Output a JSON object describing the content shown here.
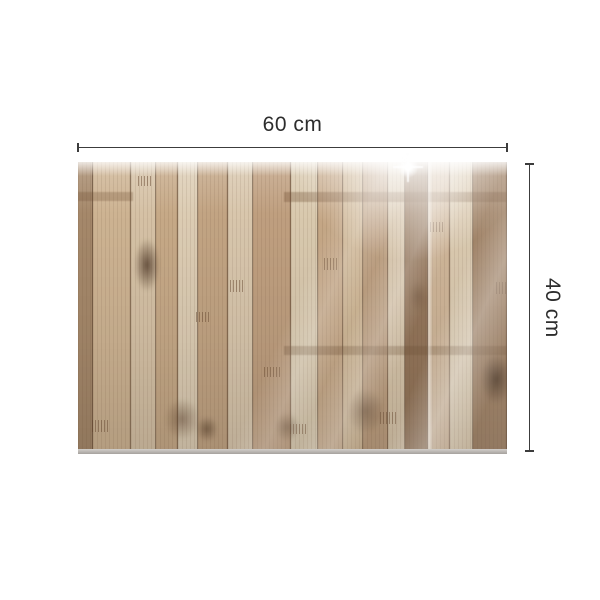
{
  "dimensions": {
    "width_label": "60 cm",
    "height_label": "40 cm",
    "line_color": "#3c3c3c",
    "label_color": "#2d2d2d"
  },
  "panel": {
    "description": "rustic wood plank print glass panel",
    "edge_color_top": "#d2cfcb",
    "edge_color_bottom": "#a6a29e",
    "seam_color": "rgba(74,52,34,0.45)",
    "planks": [
      {
        "w": 15,
        "color": "#a5886a"
      },
      {
        "w": 38,
        "color": "#cdb392"
      },
      {
        "w": 25,
        "color": "#d5c1a5"
      },
      {
        "w": 22,
        "color": "#c6a987"
      },
      {
        "w": 20,
        "color": "#dcccb3"
      },
      {
        "w": 30,
        "color": "#c2a483"
      },
      {
        "w": 25,
        "color": "#d8c6ac"
      },
      {
        "w": 38,
        "color": "#bf9f7f"
      },
      {
        "w": 27,
        "color": "#d9c9ae"
      },
      {
        "w": 25,
        "color": "#c5a786"
      },
      {
        "w": 20,
        "color": "#cdb492"
      },
      {
        "w": 25,
        "color": "#ba9b7b"
      },
      {
        "w": 17,
        "color": "#d4c1a5"
      },
      {
        "w": 23,
        "color": "#8e6e51"
      },
      {
        "w": 22,
        "color": "#cbb091"
      },
      {
        "w": 23,
        "color": "#d7c5a9"
      },
      {
        "w": 34,
        "color": "#9a7a5c"
      }
    ],
    "knots": [
      {
        "x": 56,
        "y": 76,
        "w": 26,
        "h": 54,
        "color": "rgba(66,44,28,0.75)"
      },
      {
        "x": 86,
        "y": 236,
        "w": 36,
        "h": 42,
        "color": "rgba(84,58,38,0.50)"
      },
      {
        "x": 268,
        "y": 226,
        "w": 38,
        "h": 46,
        "color": "rgba(80,54,34,0.50)"
      },
      {
        "x": 402,
        "y": 192,
        "w": 32,
        "h": 50,
        "color": "rgba(56,38,24,0.70)"
      },
      {
        "x": 118,
        "y": 254,
        "w": 22,
        "h": 26,
        "color": "rgba(70,48,30,0.55)"
      },
      {
        "x": 330,
        "y": 118,
        "w": 20,
        "h": 32,
        "color": "rgba(90,62,40,0.45)"
      },
      {
        "x": 196,
        "y": 250,
        "w": 26,
        "h": 30,
        "color": "rgba(76,52,32,0.45)"
      }
    ],
    "bands": [
      {
        "x": 206,
        "y": 30,
        "w": 223,
        "h": 10,
        "color": "rgba(108,76,48,0.32)"
      },
      {
        "x": 206,
        "y": 184,
        "w": 223,
        "h": 9,
        "color": "rgba(100,70,44,0.30)"
      },
      {
        "x": 0,
        "y": 30,
        "w": 55,
        "h": 9,
        "color": "rgba(108,76,48,0.28)"
      }
    ],
    "joint_marks": [
      {
        "x": 14,
        "y": 258,
        "w": 16,
        "h": 12
      },
      {
        "x": 60,
        "y": 14,
        "w": 14,
        "h": 10
      },
      {
        "x": 152,
        "y": 118,
        "w": 14,
        "h": 12
      },
      {
        "x": 186,
        "y": 205,
        "w": 16,
        "h": 10
      },
      {
        "x": 246,
        "y": 96,
        "w": 14,
        "h": 12
      },
      {
        "x": 302,
        "y": 250,
        "w": 16,
        "h": 12
      },
      {
        "x": 352,
        "y": 60,
        "w": 14,
        "h": 10
      },
      {
        "x": 118,
        "y": 150,
        "w": 14,
        "h": 10
      },
      {
        "x": 418,
        "y": 120,
        "w": 14,
        "h": 12
      },
      {
        "x": 212,
        "y": 262,
        "w": 16,
        "h": 10
      }
    ],
    "joint_mark_color": "rgba(96,66,42,0.55)"
  }
}
